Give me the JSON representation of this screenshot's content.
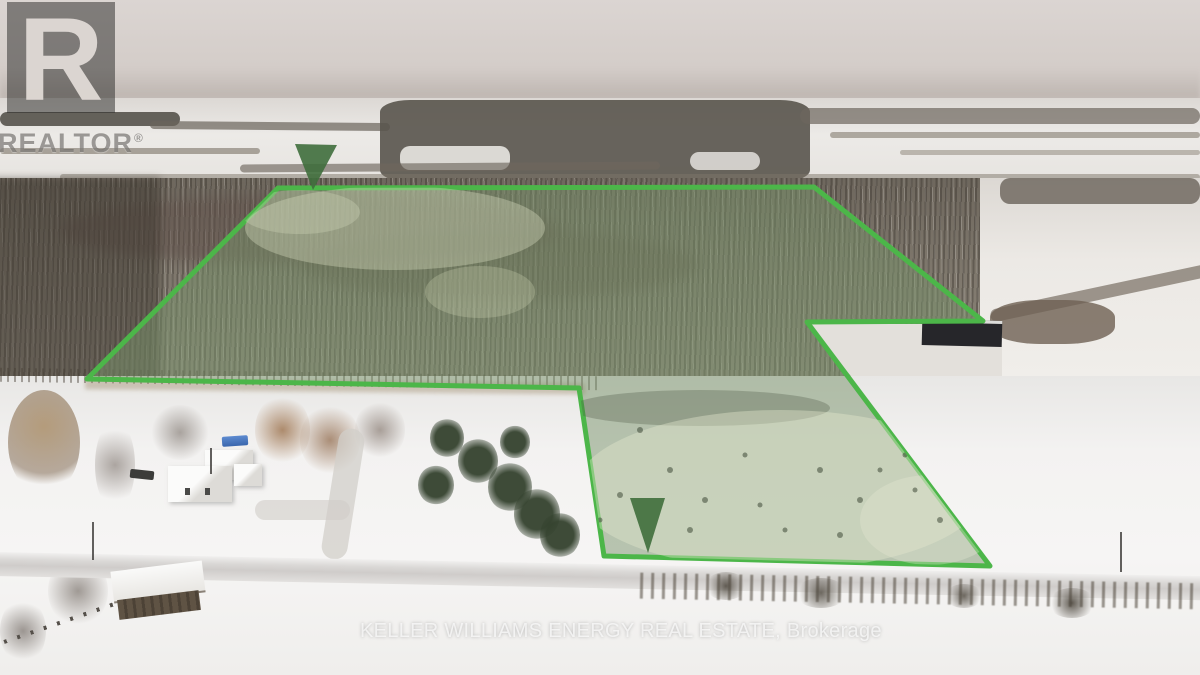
{
  "branding": {
    "realtor_logo": {
      "letter": "R",
      "wordmark": "REALTOR",
      "registered_mark": "®"
    },
    "brokerage_watermark": "KELLER WILLIAMS ENERGY REAL ESTATE, Brokerage"
  },
  "boundary_overlay": {
    "stroke_color": "#4cb649",
    "fill_color": "#78916a",
    "fill_opacity": "0.5",
    "marker_color": "#3f6e3c",
    "marker_opacity": "0.9"
  }
}
